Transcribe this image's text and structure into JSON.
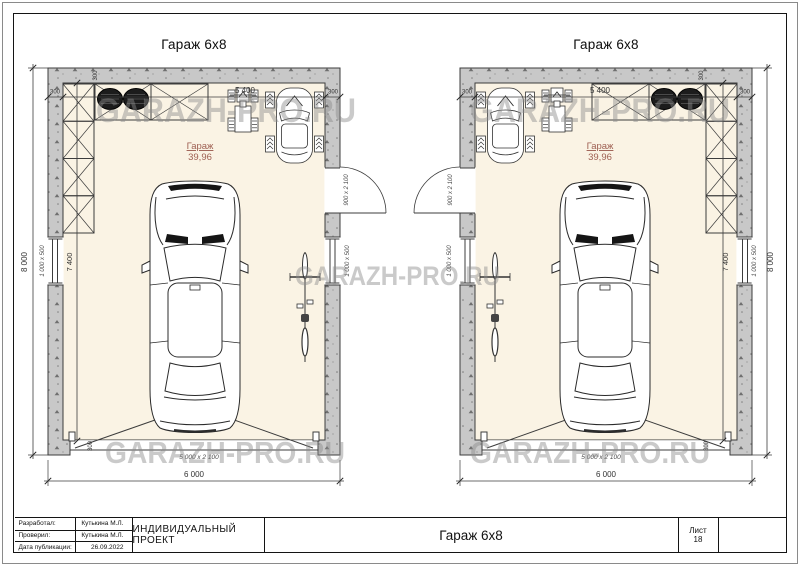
{
  "sheet": {
    "plan_title": "Гараж 6x8",
    "watermark_text": "GARAZH-PRO.RU",
    "room_label": "Гараж",
    "room_area": "39,96",
    "dim_width_total": "6 000",
    "dim_height_total": "8 000",
    "dim_inner_width": "5 400",
    "dim_inner_height": "7 400",
    "dim_wall": "300",
    "gate_size": "5 000 x 2 100",
    "door_size": "900 x 2 100",
    "window_size": "1 000 x 500"
  },
  "title_block": {
    "rows": [
      {
        "label": "Разработал:",
        "value": "Кутькина М.Л."
      },
      {
        "label": "Проверил:",
        "value": "Кутькина М.Л."
      },
      {
        "label": "Дата публикации:",
        "value": "26.09.2022"
      }
    ],
    "project_type": "ИНДИВИДУАЛЬНЫЙ ПРОЕКТ",
    "doc_title": "Гараж 6x8",
    "sheet_label": "Лист",
    "sheet_number": "18"
  },
  "colors": {
    "wall": "#c8c8c8",
    "floor": "#faf3e4",
    "line": "#3c3c3c",
    "room_label": "#9e5f52",
    "watermark": "#8c8c8c",
    "dim_text": "#333333"
  }
}
